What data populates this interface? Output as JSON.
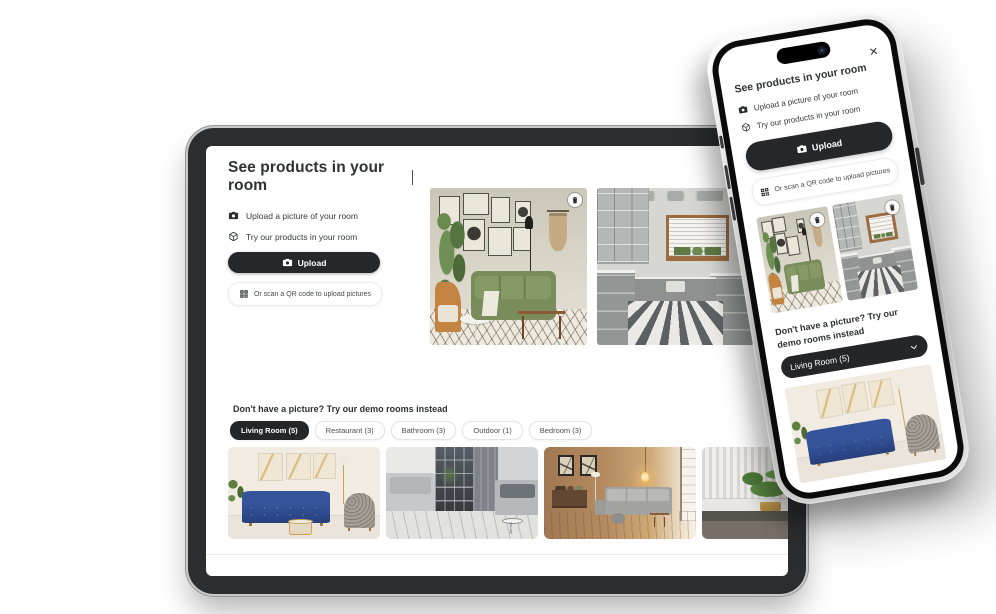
{
  "colors": {
    "accent_dark": "#26272a",
    "page_background": "#ffffff",
    "active_tab_background": "#242629",
    "divider": "#ededed"
  },
  "widget": {
    "title": "See products in your room",
    "steps": [
      {
        "icon": "camera-icon",
        "label": "Upload a picture of your room"
      },
      {
        "icon": "cube-icon",
        "label": "Try our products in your room"
      }
    ],
    "upload_button_label": "Upload",
    "qr_button_label": "Or scan a QR code to upload pictures",
    "demo_heading": "Don't have a picture? Try our demo rooms instead"
  },
  "tablet": {
    "tabs": [
      {
        "label": "Living Room (5)",
        "active": true
      },
      {
        "label": "Restaurant (3)",
        "active": false
      },
      {
        "label": "Bathroom (3)",
        "active": false
      },
      {
        "label": "Outdoor (1)",
        "active": false
      },
      {
        "label": "Bedroom (3)",
        "active": false
      }
    ],
    "uploaded_images": [
      {
        "name": "living-room-green-sofa"
      },
      {
        "name": "kitchen-striped-floor"
      }
    ],
    "demo_images": [
      {
        "name": "living-room-blue-sofa"
      },
      {
        "name": "loft-gray-sofas"
      },
      {
        "name": "warm-living-room-sectional"
      },
      {
        "name": "plant-corner"
      }
    ]
  },
  "phone": {
    "close_label": "✕",
    "dropdown_selected_label": "Living Room (5)",
    "uploaded_images": [
      {
        "name": "living-room-green-sofa"
      },
      {
        "name": "kitchen-striped-floor"
      }
    ],
    "demo_image": {
      "name": "living-room-blue-sofa"
    }
  }
}
